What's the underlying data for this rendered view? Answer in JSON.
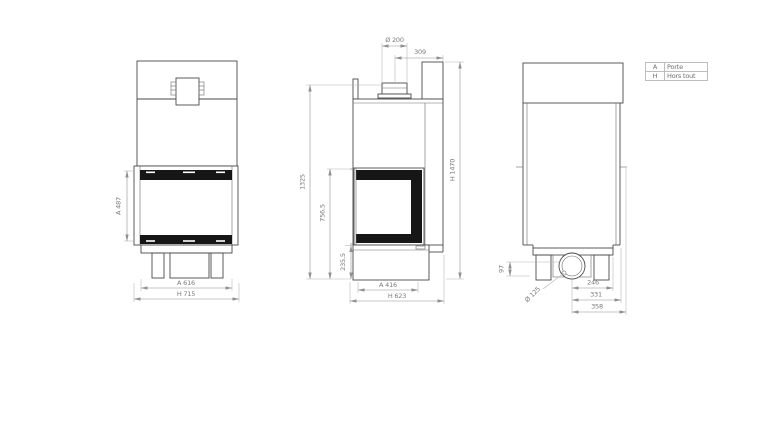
{
  "drawing": {
    "colors": {
      "object_line": "#4a4a4a",
      "dimension_line": "#8f8f8f",
      "extension_line": "#b3b3b3",
      "door_frame_fill": "#161616",
      "dimension_text": "#7a7a7a",
      "background": "#ffffff"
    },
    "views": {
      "front": {
        "dims": {
          "door_height": "A 487",
          "door_width": "A 616",
          "overall_width": "H 715"
        }
      },
      "side": {
        "dims": {
          "flue_diameter": "Ø 200",
          "flue_center_to_back": "309",
          "flue_height": "1325",
          "door_top_height": "756,5",
          "base_height": "235,5",
          "overall_height": "H 1470",
          "door_depth": "A 416",
          "overall_depth": "H 623"
        }
      },
      "rear": {
        "dims": {
          "socket_height": "97",
          "socket_diameter": "Ø 125",
          "socket_to_plate_edge": "246",
          "socket_to_body_edge": "331",
          "socket_to_overall_edge": "358"
        }
      }
    },
    "legend": {
      "rows": [
        {
          "key": "A",
          "label": "Porte"
        },
        {
          "key": "H",
          "label": "Hors tout"
        }
      ]
    }
  }
}
